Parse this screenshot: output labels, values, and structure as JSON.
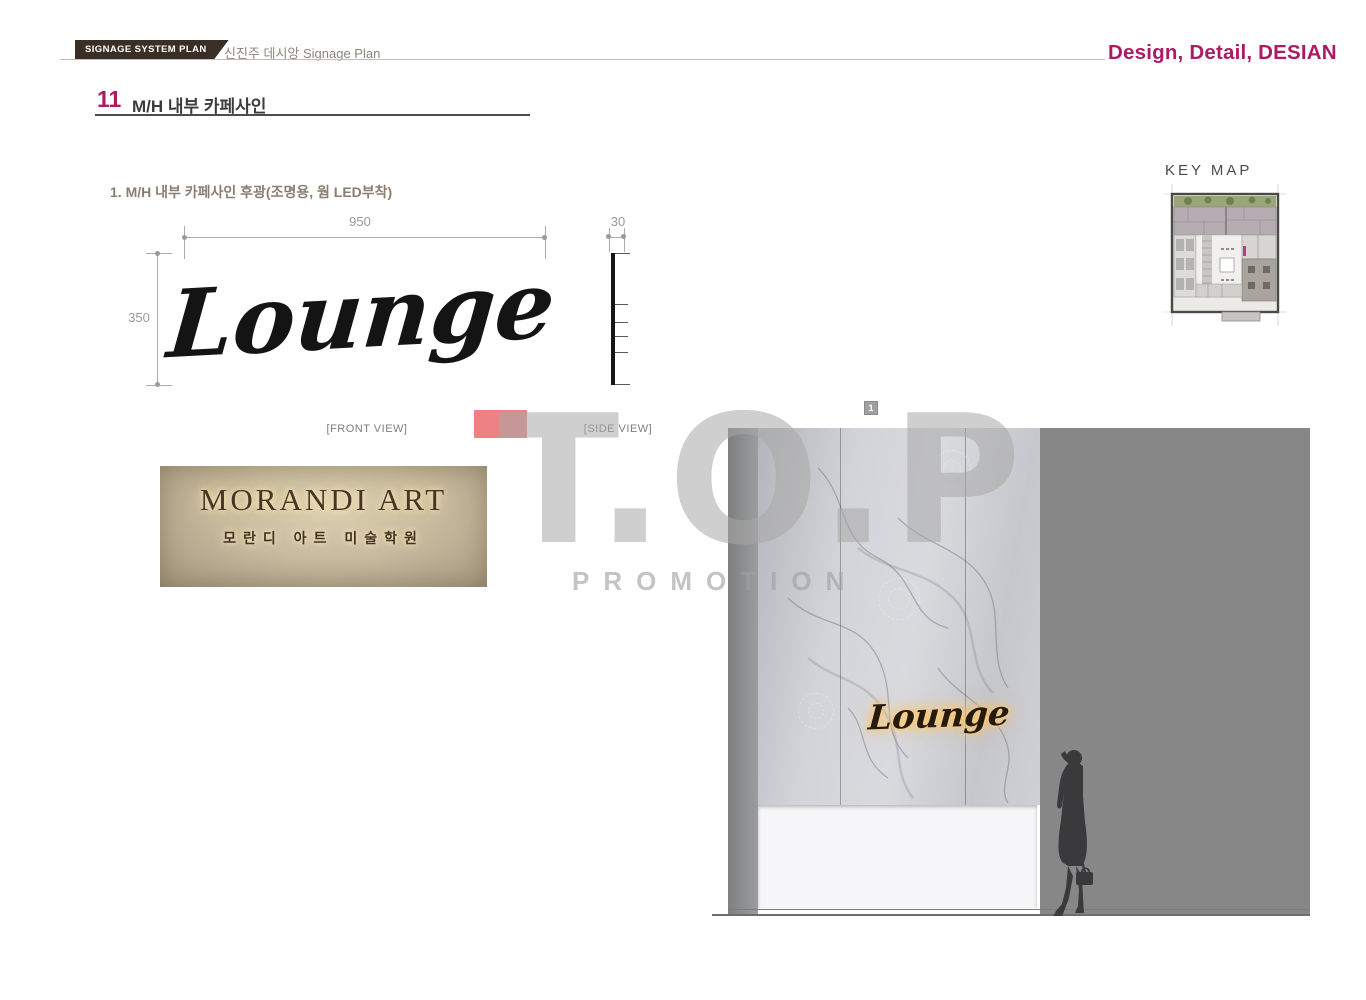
{
  "header": {
    "badge": "SIGNAGE SYSTEM PLAN",
    "project": "신진주 데시앙 Signage Plan",
    "slogan": "Design, Detail, DESIAN",
    "accent_color": "#ae1a63",
    "badge_color": "#3a2f26"
  },
  "section": {
    "number": "11",
    "title": "M/H 내부 카페사인"
  },
  "subtitle": "1. M/H 내부 카페사인 후광(조명용, 웜 LED부착)",
  "front_view": {
    "label": "[FRONT VIEW]",
    "artwork_text": "Lounge",
    "dim_width": "950",
    "dim_height": "350"
  },
  "side_view": {
    "label": "[SIDE VIEW]",
    "dim_depth": "30"
  },
  "photo": {
    "line1": "MORANDI ART",
    "line2": "모란디 아트 미술학원"
  },
  "watermark": {
    "line1": "T.O.P",
    "line2": "PROMOTION",
    "accent_color": "#ee8183"
  },
  "keymap": {
    "label": "KEY MAP",
    "marker_color": "#c0397e"
  },
  "rendering": {
    "badge": "1",
    "sign_text": "Lounge"
  }
}
